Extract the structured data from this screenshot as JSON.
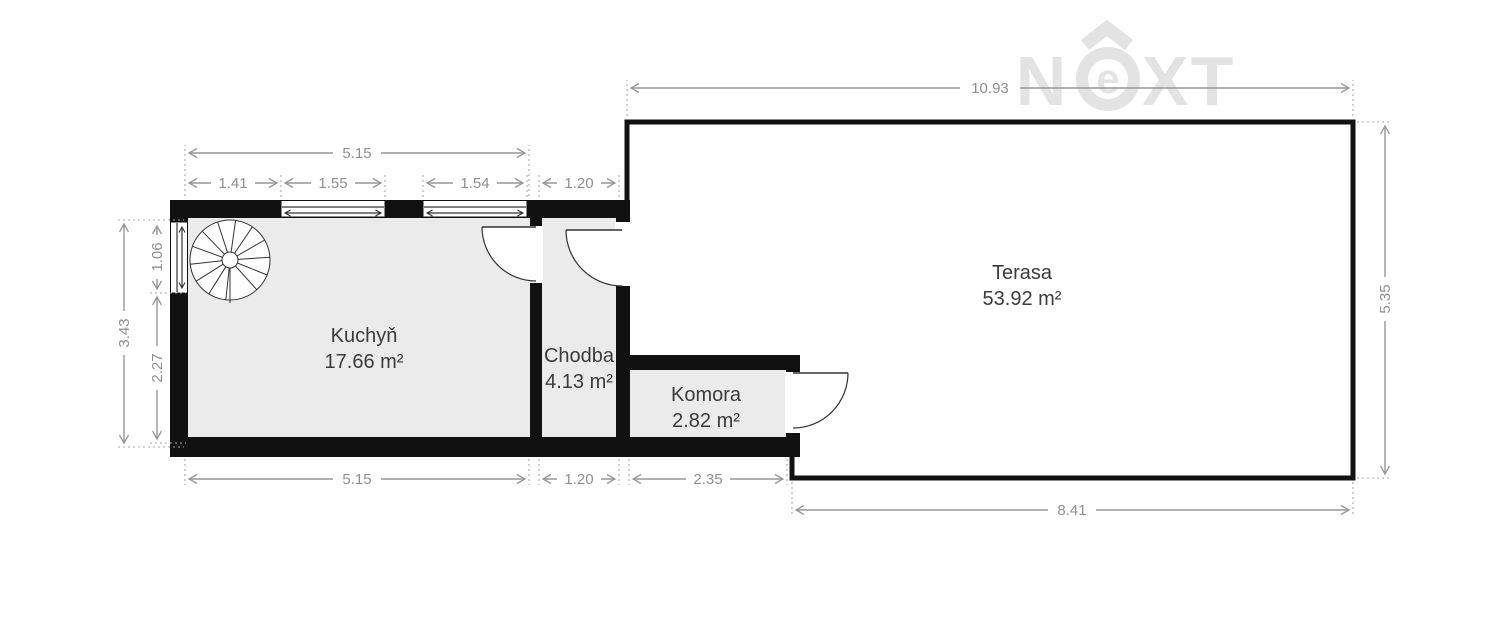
{
  "watermark": {
    "letter_n": "N",
    "letter_e": "e",
    "letter_x": "X",
    "letter_t": "T"
  },
  "rooms": {
    "kuchyn": {
      "name": "Kuchyň",
      "area": "17.66 m²"
    },
    "chodba": {
      "name": "Chodba",
      "area": "4.13 m²"
    },
    "komora": {
      "name": "Komora",
      "area": "2.82 m²"
    },
    "terasa": {
      "name": "Terasa",
      "area": "53.92 m²"
    }
  },
  "dimensions": {
    "terrace_top_width": "10.93",
    "kitchen_top_width": "5.15",
    "kitchen_top_left_segment": "1.41",
    "kitchen_window_left": "1.55",
    "kitchen_window_right": "1.54",
    "hall_top_width": "1.20",
    "left_total_height": "3.43",
    "left_window_height": "1.06",
    "left_below_window_height": "2.27",
    "kitchen_bottom_width": "5.15",
    "hall_bottom_width": "1.20",
    "pantry_bottom_width": "2.35",
    "terrace_bottom_width": "8.41",
    "terrace_right_height": "5.35"
  },
  "colors": {
    "wall": "#111111",
    "room_fill": "#ebebeb",
    "terrace_fill": "#ffffff",
    "dimension_gray": "#979797",
    "label_text": "#3b3b3b",
    "watermark_gray": "#e3e3e3"
  }
}
